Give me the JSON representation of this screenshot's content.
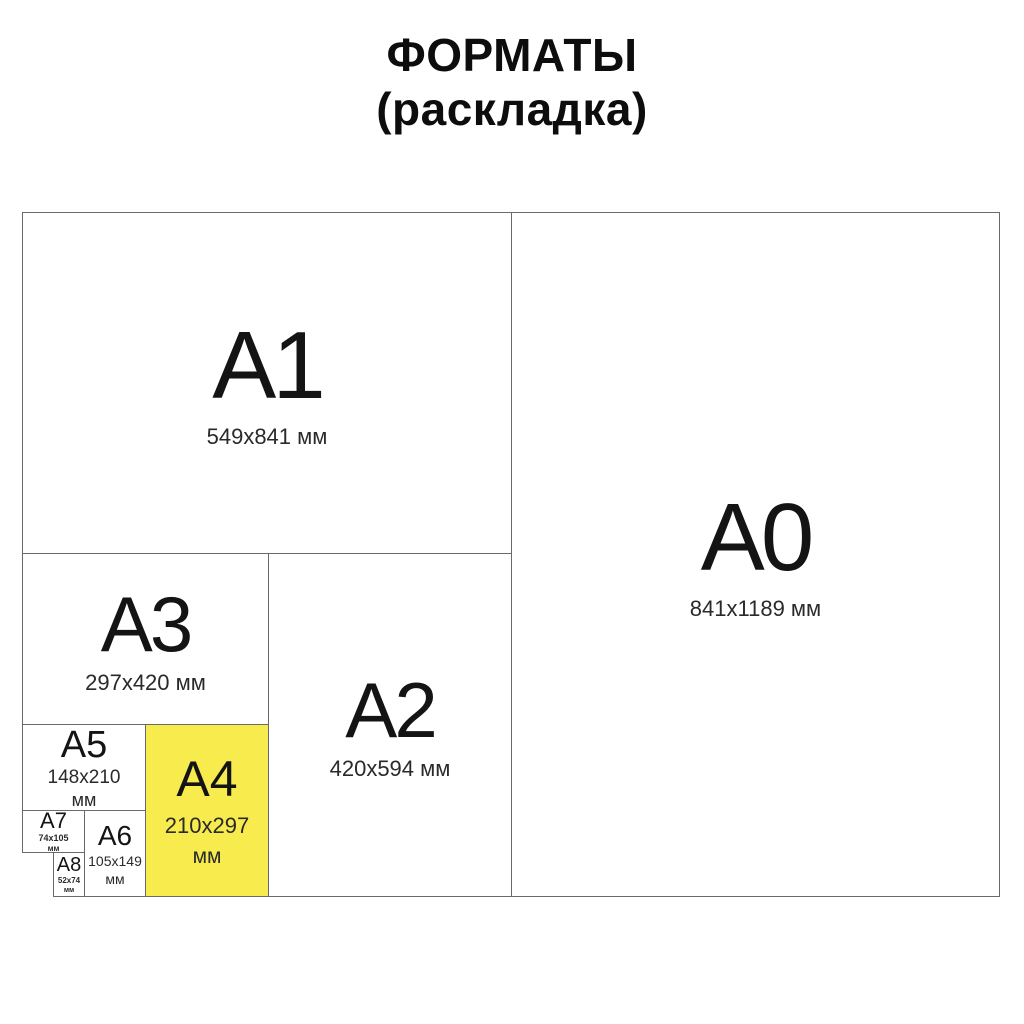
{
  "title": {
    "line1": "ФОРМАТЫ",
    "line2": "(раскладка)"
  },
  "colors": {
    "highlight_yellow": "#F8EB4D",
    "border_gray": "#6A6A6A",
    "label_black": "#141414",
    "background": "#FFFFFF"
  },
  "formats": {
    "a0": {
      "label": "A0",
      "size": "841x1189 мм"
    },
    "a1": {
      "label": "A1",
      "size": "549x841 мм"
    },
    "a2": {
      "label": "A2",
      "size": "420x594 мм"
    },
    "a3": {
      "label": "A3",
      "size": "297x420 мм"
    },
    "a4": {
      "label": "A4",
      "size": "210x297",
      "unit": "мм"
    },
    "a5": {
      "label": "A5",
      "size": "148x210",
      "unit": "мм"
    },
    "a6": {
      "label": "A6",
      "size": "105x149",
      "unit": "мм"
    },
    "a7": {
      "label": "A7",
      "size": "74x105",
      "unit": "мм"
    },
    "a8": {
      "label": "A8",
      "size": "52x74",
      "unit": "мм"
    }
  }
}
